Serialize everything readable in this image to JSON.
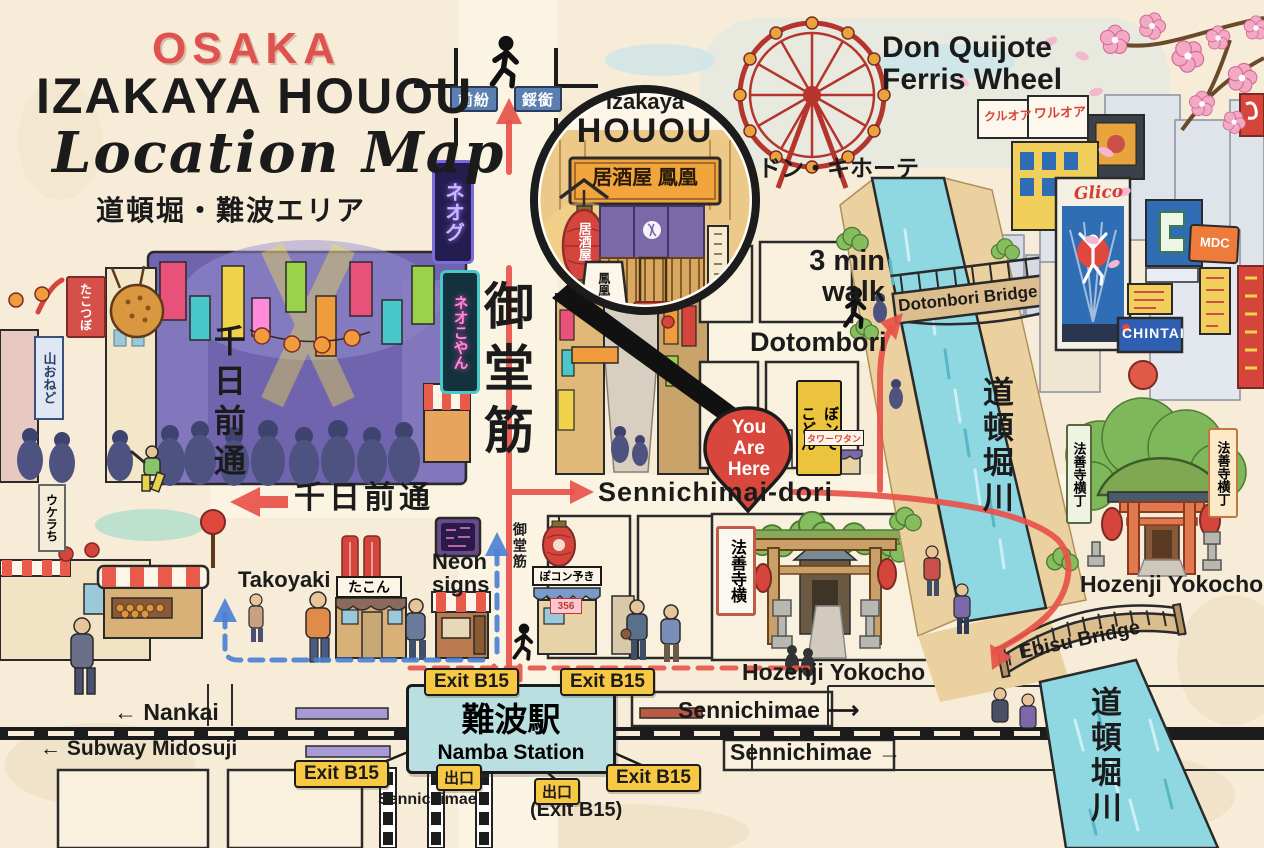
{
  "title": {
    "city": "OSAKA",
    "name": "IZAKAYA HOUOU",
    "script": "Location Map",
    "area": "道頓堀・難波エリア"
  },
  "top_signs": {
    "left": "前紛",
    "right": "鋖銜"
  },
  "inset": {
    "en1": "Izakaya",
    "en2": "HOUOU",
    "signboard": "居酒屋 鳳凰",
    "lantern": "居酒屋",
    "board": "鳳凰"
  },
  "landmarks": {
    "ferris_line1": "Don Quijote",
    "ferris_line2": "Ferris Wheel",
    "donki": "ドン・キホーテ",
    "walk_line1": "3 min",
    "walk_line2": "walk",
    "dotombori": "Dotombori",
    "yah_line1": "You",
    "yah_line2": "Are",
    "yah_line3": "Here",
    "dotonbori_bridge": "Dotonbori Bridge",
    "river_upper": "道頓堀川",
    "river_lower": "道頓堀川",
    "ebisu_bridge": "Ebisu Bridge",
    "hozenji_sign_center": "法善寺横",
    "hozenji_center": "Hozenji Yokocho",
    "hozenji_sign_right_a": "法善寺横丁",
    "hozenji_sign_right_b": "法善寺横丁",
    "hozenji_right": "Hozenji Yokocho"
  },
  "billboards": {
    "kana_a": "クルオア",
    "kana_b": "ワルオア",
    "glico": "Glico",
    "chintai": "CHINTAI",
    "mdc": "MDC"
  },
  "streets": {
    "midosuji": "御堂筋",
    "midosuji_small": "御堂筋",
    "sennichimai_dori": "Sennichimai-dori",
    "sennichi_vertical": "千日前通",
    "sennichi_horizontal": "千日前通"
  },
  "shops": {
    "takoyaki": "Takoyaki",
    "neon_line1": "Neon",
    "neon_line2": "signs",
    "takon": "たこん",
    "ponko": "ぽコン予き",
    "price": "356",
    "yellow_sign_a": "ぼンて",
    "yellow_sign_b": "こどん",
    "small_red_sign": "タワーワタン"
  },
  "left_side": {
    "tako_tsubo": "たこつぼ",
    "blue_sign": "山おねど",
    "neon_purple": "ネオグ",
    "neon_pink": "ネオこやん",
    "lower_sign": "ウケラち"
  },
  "station": {
    "name_jp": "難波駅",
    "name_en": "Namba Station",
    "exit_b15": "Exit B15",
    "exit_paren": "(Exit B15)",
    "deguchi": "出口",
    "nankai": "← Nankai",
    "subway_midosuji": "← Subway Midosuji",
    "sennichimae": "Sennichimae",
    "sennichimae_upper": "Sennichimae ⟶",
    "sennichimae_lower": "Sennichimae →"
  },
  "colors": {
    "accent_red": "#e8534a",
    "route_blue": "#4a7fd4",
    "canal_blue": "#8fd8e2",
    "badge_yellow": "#f6c844",
    "station_fill": "#b9dfe1",
    "paper": "#f6ecd8",
    "pin_red": "#d8463c"
  }
}
